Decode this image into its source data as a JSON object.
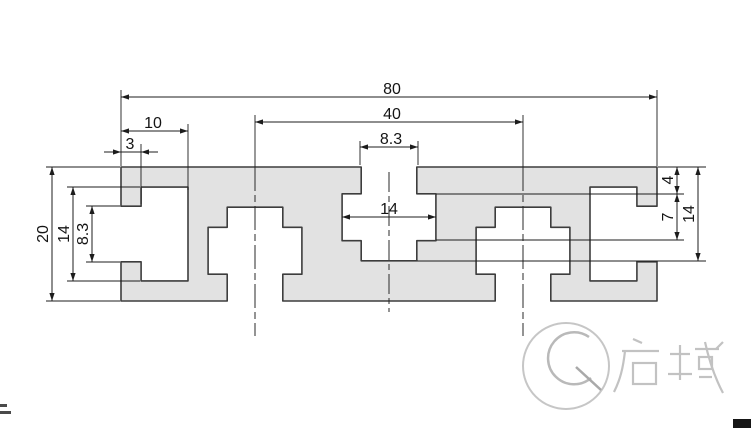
{
  "drawing": {
    "type": "technical-drawing",
    "subject": "aluminum-extrusion-profile-cross-section-20x80",
    "dimensions": {
      "overall_width": "80",
      "slot_center_distance": "40",
      "end_slot_depth": "10",
      "end_slot_lip_thickness": "3",
      "top_slot_opening": "8.3",
      "top_slot_cavity_width": "14",
      "overall_height": "20",
      "end_slot_cavity_height": "14",
      "end_slot_opening": "8.3",
      "slot_neck_depth": "4",
      "slot_cavity_height": "7",
      "slot_total_depth": "14"
    }
  },
  "watermark": {
    "logo_text": "启域",
    "logo_mark": "Q"
  },
  "colors": {
    "background": "#ffffff",
    "profile_fill": "#e2e2e2",
    "profile_outline": "#3d3d3d",
    "dimension_line": "#1c1c1c",
    "dimension_text": "#141414",
    "watermark_gray": "#c3c3c3"
  }
}
